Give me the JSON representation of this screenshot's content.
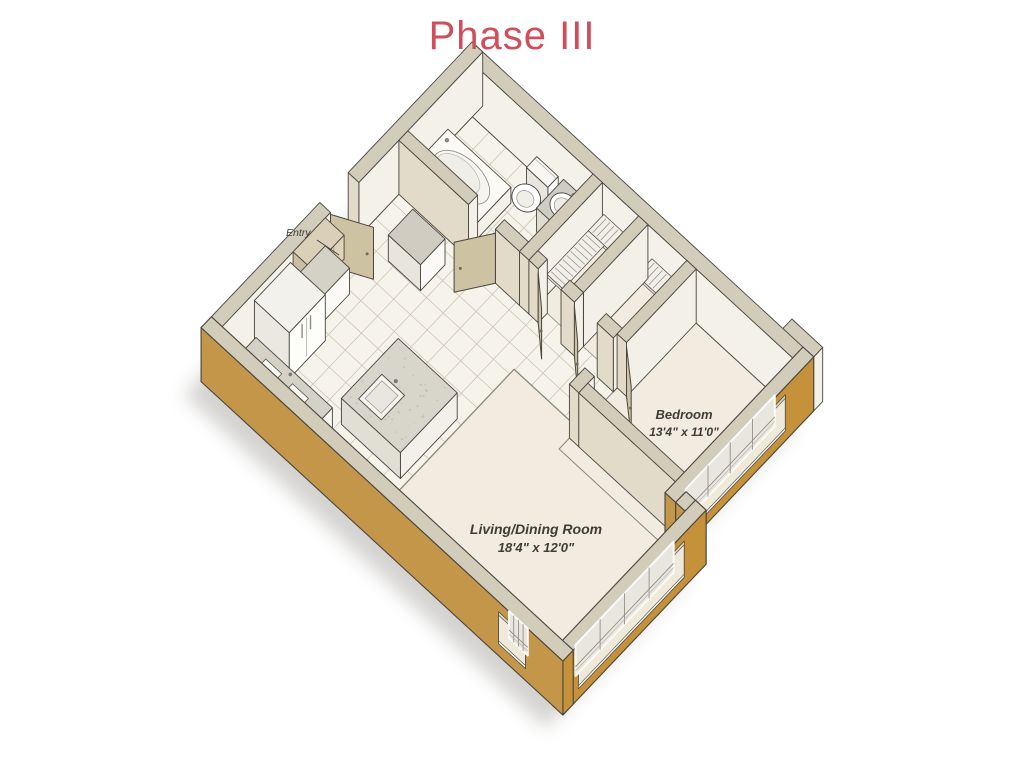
{
  "title": "Phase III",
  "labels": {
    "entry": "Entry",
    "bedroom_name": "Bedroom",
    "bedroom_dims": "13'4\" x 11'0\"",
    "living_name": "Living/Dining Room",
    "living_dims": "18'4\" x 12'0\""
  },
  "colors": {
    "title": "#d04e5a",
    "label_text": "#3e3d3a",
    "wall_gold": "#c5913a",
    "wall_gold_shade": "#c3964a",
    "wall_top": "#d2ccba",
    "wall_face_light": "#f3f0e8",
    "wall_face_shade": "#e2dbc9",
    "floor_cream": "#f1ecdf",
    "floor_tile": "#f6f3ea",
    "tile_line": "#c7c0b0",
    "door_tan": "#cdc2a2",
    "counter_gray": "#d4d1c7",
    "outline": "#4a463f"
  }
}
